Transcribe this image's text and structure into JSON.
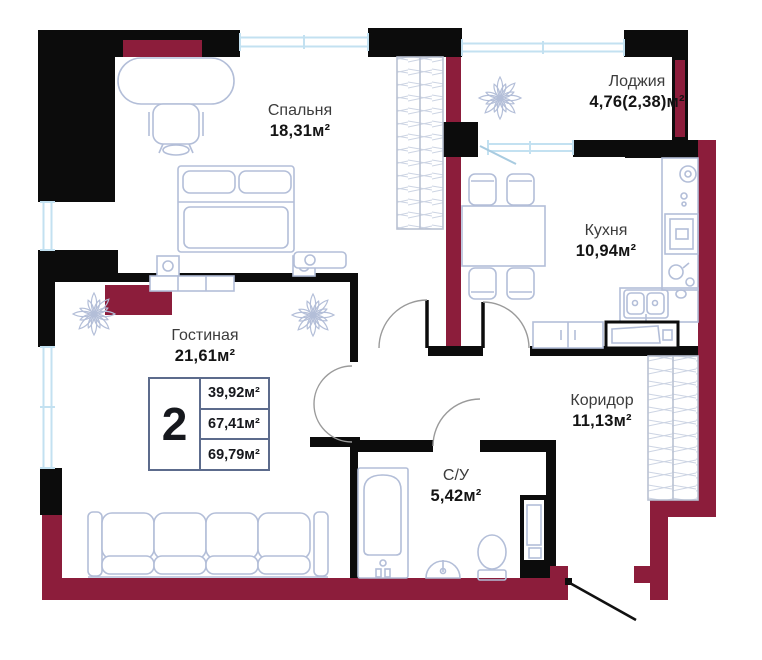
{
  "plan": {
    "rooms": [
      {
        "id": "bedroom",
        "name": "Спальня",
        "area": "18,31м²"
      },
      {
        "id": "loggia",
        "name": "Лоджия",
        "area": "4,76(2,38)м²"
      },
      {
        "id": "kitchen",
        "name": "Кухня",
        "area": "10,94м²"
      },
      {
        "id": "living",
        "name": "Гостиная",
        "area": "21,61м²"
      },
      {
        "id": "corridor",
        "name": "Коридор",
        "area": "11,13м²"
      },
      {
        "id": "bathroom",
        "name": "С/У",
        "area": "5,42м²"
      }
    ],
    "stats": {
      "rooms_count": "2",
      "areas": [
        "39,92м²",
        "67,41м²",
        "69,79м²"
      ]
    },
    "colors": {
      "wall": "#0c0c0c",
      "accent": "#8C1D3B",
      "furniture": "#b3bed8",
      "window": "#c3e1f1",
      "stats_border": "#5c6b8c"
    }
  }
}
